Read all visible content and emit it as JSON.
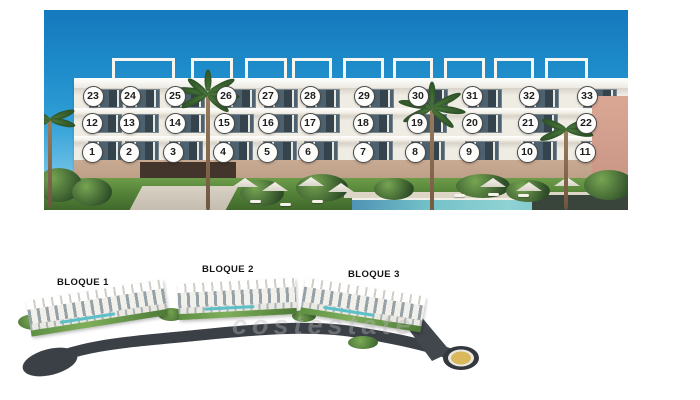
{
  "colors": {
    "sky_top": "#1579bd",
    "sky_horizon": "#9ed4ee",
    "facade_white": "#f4f1ea",
    "base_tan": "#c9aa92",
    "window_glass": "#34434c",
    "lawn_green": "#558439",
    "pool_teal": "#74c2c8",
    "road_dark": "#3b4047",
    "roundabout_fill": "#d9b95c",
    "marker_border": "#4a4a4a"
  },
  "facade_photo": {
    "units": [
      {
        "label": "1",
        "x": 48,
        "y": 142
      },
      {
        "label": "2",
        "x": 85,
        "y": 142
      },
      {
        "label": "3",
        "x": 129,
        "y": 142
      },
      {
        "label": "4",
        "x": 179,
        "y": 142
      },
      {
        "label": "5",
        "x": 223,
        "y": 142
      },
      {
        "label": "6",
        "x": 264,
        "y": 142
      },
      {
        "label": "7",
        "x": 319,
        "y": 142
      },
      {
        "label": "8",
        "x": 371,
        "y": 142
      },
      {
        "label": "9",
        "x": 425,
        "y": 142
      },
      {
        "label": "10",
        "x": 483,
        "y": 142
      },
      {
        "label": "11",
        "x": 541,
        "y": 142
      },
      {
        "label": "12",
        "x": 48,
        "y": 113
      },
      {
        "label": "13",
        "x": 85,
        "y": 113
      },
      {
        "label": "14",
        "x": 131,
        "y": 113
      },
      {
        "label": "15",
        "x": 180,
        "y": 113
      },
      {
        "label": "16",
        "x": 224,
        "y": 113
      },
      {
        "label": "17",
        "x": 266,
        "y": 113
      },
      {
        "label": "18",
        "x": 319,
        "y": 113
      },
      {
        "label": "19",
        "x": 373,
        "y": 113
      },
      {
        "label": "20",
        "x": 428,
        "y": 113
      },
      {
        "label": "21",
        "x": 484,
        "y": 113
      },
      {
        "label": "22",
        "x": 542,
        "y": 113
      },
      {
        "label": "23",
        "x": 49,
        "y": 86
      },
      {
        "label": "24",
        "x": 86,
        "y": 86
      },
      {
        "label": "25",
        "x": 131,
        "y": 86
      },
      {
        "label": "26",
        "x": 182,
        "y": 86
      },
      {
        "label": "27",
        "x": 224,
        "y": 86
      },
      {
        "label": "28",
        "x": 266,
        "y": 86
      },
      {
        "label": "29",
        "x": 320,
        "y": 86
      },
      {
        "label": "30",
        "x": 374,
        "y": 86
      },
      {
        "label": "31",
        "x": 428,
        "y": 86
      },
      {
        "label": "32",
        "x": 485,
        "y": 86
      },
      {
        "label": "33",
        "x": 543,
        "y": 86
      }
    ]
  },
  "site_plan": {
    "blocks": [
      {
        "label": "BLOQUE 1"
      },
      {
        "label": "BLOQUE 2"
      },
      {
        "label": "BLOQUE 3"
      }
    ],
    "watermark": "costestate"
  }
}
